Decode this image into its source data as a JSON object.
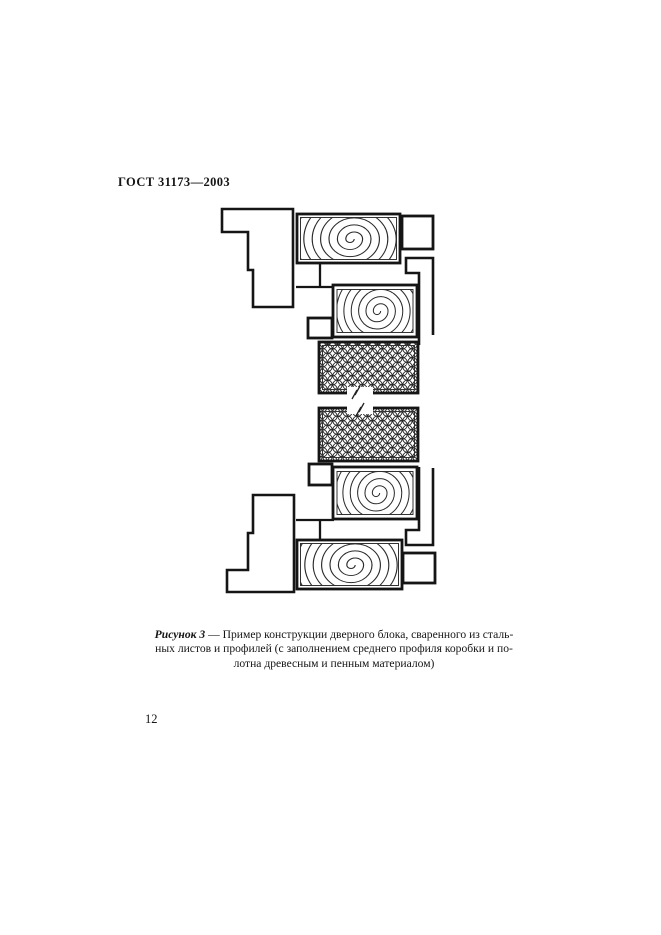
{
  "page": {
    "header": "ГОСТ 31173—2003",
    "page_number": "12"
  },
  "figure": {
    "caption": {
      "label": "Рисунок 3",
      "line1_rest": " — Пример конструкции дверного блока, сваренного из сталь-",
      "line2": "ных листов и профилей (с заполнением среднего профиля коробки и по-",
      "line3": "лотна древесным и пенным материалом)"
    }
  },
  "colors": {
    "ink": "#151515",
    "paper": "#ffffff"
  }
}
